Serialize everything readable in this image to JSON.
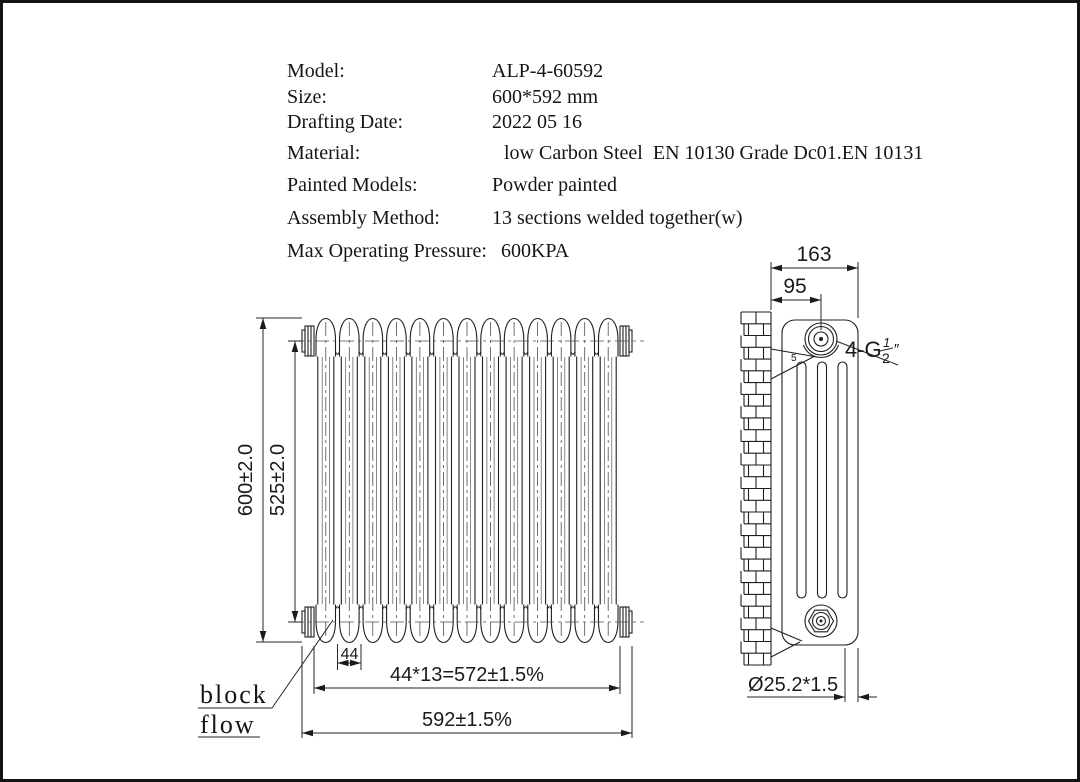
{
  "specs": {
    "rows": [
      {
        "label": "Model:",
        "value": "ALP-4-60592"
      },
      {
        "label": "Size:",
        "value": "600*592 mm"
      },
      {
        "label": "Drafting Date:",
        "value": "2022 05 16"
      },
      {
        "label": "Material:",
        "value": "low Carbon Steel  EN 10130 Grade Dc01.EN 10131"
      },
      {
        "label": "Painted Models:",
        "value": "Powder painted"
      },
      {
        "label": "Assembly Method:",
        "value": "13 sections welded together(w)"
      },
      {
        "label": "Max Operating Pressure:",
        "value": "600KPA"
      }
    ]
  },
  "front_view": {
    "sections_count": 13,
    "dim_height_overall": "600±2.0",
    "dim_height_centers": "525±2.0",
    "dim_section_width": "44",
    "dim_sections_total": "44*13=572±1.5%",
    "dim_width_overall": "592±1.5%",
    "label_line1": "block",
    "label_line2": "flow"
  },
  "side_view": {
    "dim_depth": "163",
    "dim_port_offset": "95",
    "dim_pipe": "Ø25.2*1.5",
    "conn_prefix": "4-G",
    "conn_frac_num": "1",
    "conn_frac_den": "2",
    "conn_unit": "″",
    "weld_mark": "5"
  },
  "colors": {
    "line": "#1f1f1f",
    "dim": "#262626",
    "centerline": "#4d4d4d",
    "background": "#ffffff",
    "frame": "#141414"
  }
}
